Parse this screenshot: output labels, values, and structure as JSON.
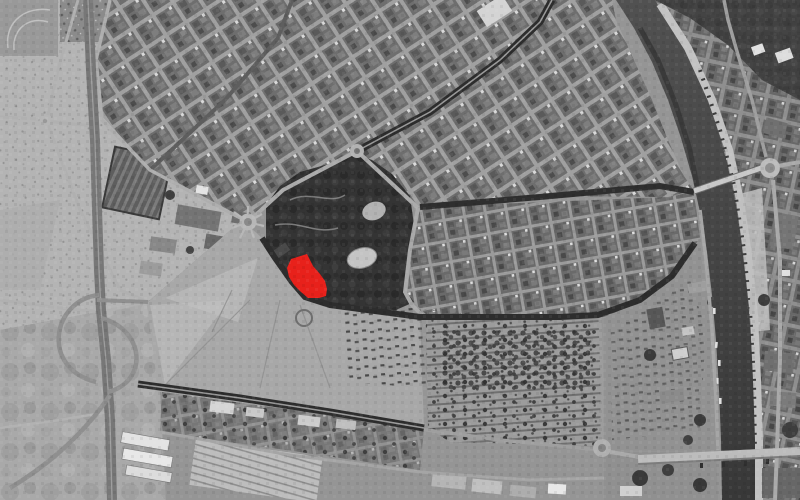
{
  "meta": {
    "description": "Grayscale aerial orthophoto of a riverside city with one development site highlighted in solid red at the southwest corner of a large park",
    "image_kind": "satellite-orthophoto",
    "color_mode": "grayscale-plus-red-highlight"
  },
  "palette": {
    "highlight_red": "#e8211b",
    "park_canopy": "#343434",
    "river_water": "#454545",
    "open_fields": "#b4b4b4",
    "esplanade": "#a8a8a8",
    "urban_blocks": "#6e6e6e",
    "streets_light": "#a2a2a2",
    "tree_lined_avenue": "#2d2d2d",
    "bridge_deck": "#c6c6c6",
    "quay_edge": "#c2c2c2"
  },
  "site": {
    "name": "highlighted-site",
    "points": "291,259 307,254 313,266 320,274 325,281 327,289 326,296 319,298 308,298 301,292 294,285 289,277 287,268",
    "fill": "#e8211b"
  },
  "features": [
    {
      "name": "orchard-fields-northwest"
    },
    {
      "name": "motorway-interchange-west"
    },
    {
      "name": "dense-urban-fabric-north"
    },
    {
      "name": "gridded-district-east-of-park"
    },
    {
      "name": "large-park-center"
    },
    {
      "name": "park-pond"
    },
    {
      "name": "red-highlighted-site"
    },
    {
      "name": "open-esplanade-center"
    },
    {
      "name": "fairground-rows-southeast"
    },
    {
      "name": "tree-lined-avenues"
    },
    {
      "name": "river-east-with-boats"
    },
    {
      "name": "upper-bridge-with-roundabout"
    },
    {
      "name": "lower-bridge-south"
    },
    {
      "name": "east-bank-district-and-quay"
    },
    {
      "name": "industrial-sheds-southwest"
    }
  ]
}
